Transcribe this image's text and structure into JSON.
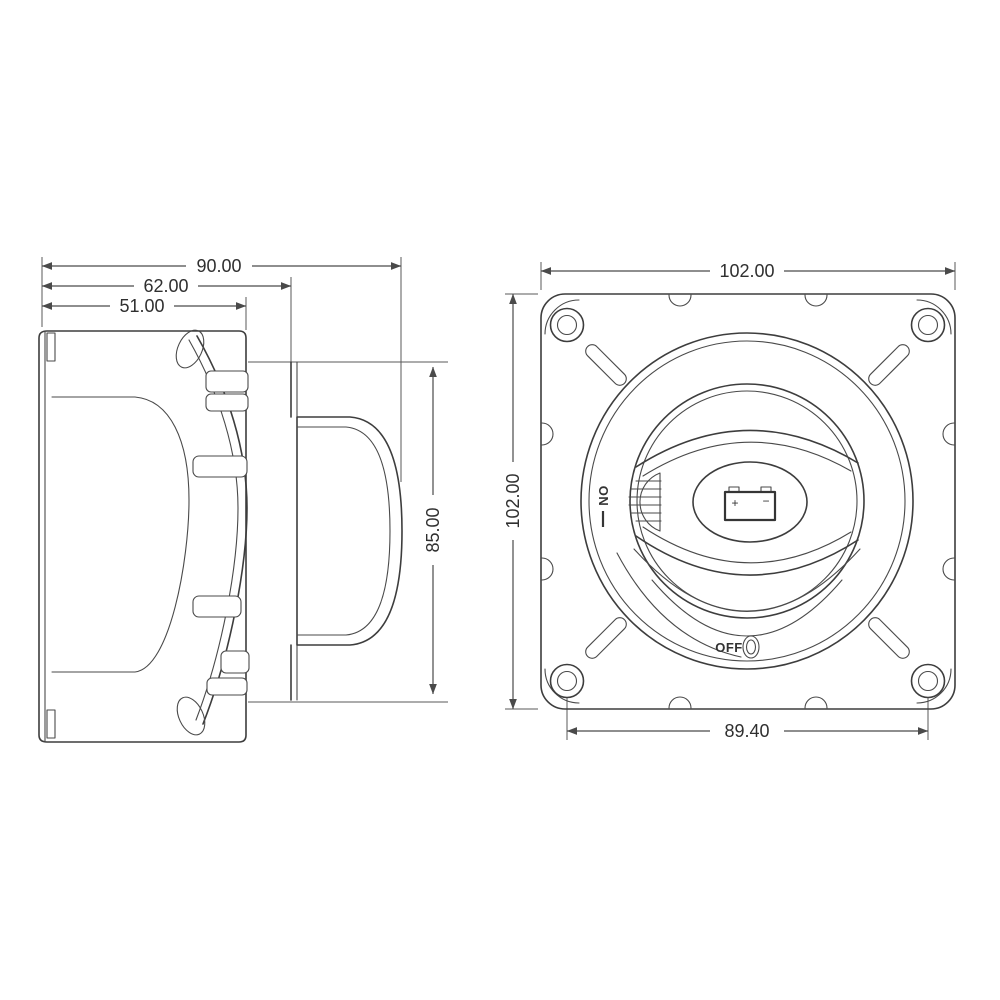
{
  "drawing": {
    "type": "engineering-dimension-drawing",
    "subject": "battery disconnect switch, side view and front view",
    "colors": {
      "background": "#ffffff",
      "line": "#3d3d3d",
      "dimension_line": "#4a4a4a",
      "text": "#2f2f2f"
    },
    "side_view": {
      "dimensions": {
        "overall_depth": "90.00",
        "depth_to_panel": "62.00",
        "body_depth": "51.00",
        "bezel_height": "85.00"
      }
    },
    "front_view": {
      "dimensions": {
        "plate_width": "102.00",
        "plate_height": "102.00",
        "mount_hole_spacing": "89.40"
      },
      "labels": {
        "on": "ON",
        "off": "OFF",
        "battery_positive": "+",
        "battery_negative": "−"
      }
    }
  }
}
